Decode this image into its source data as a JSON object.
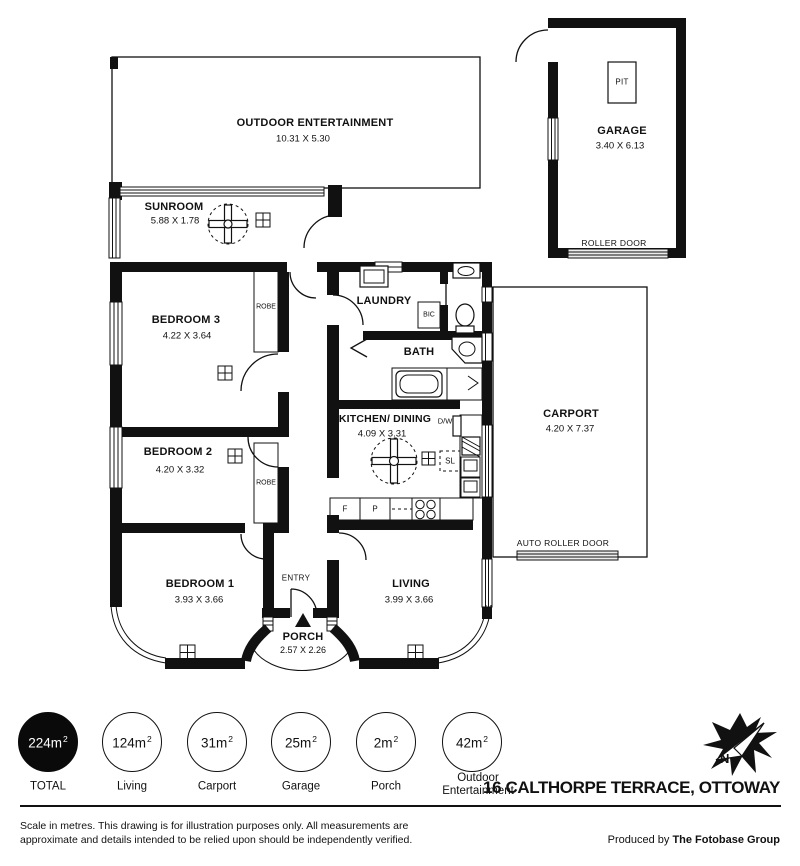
{
  "rooms": {
    "outdoor": {
      "name": "OUTDOOR ENTERTAINMENT",
      "dims": "10.31 X 5.30"
    },
    "garage": {
      "name": "GARAGE",
      "dims": "3.40 X 6.13"
    },
    "sunroom": {
      "name": "SUNROOM",
      "dims": "5.88 X 1.78"
    },
    "bedroom3": {
      "name": "BEDROOM 3",
      "dims": "4.22 X 3.64"
    },
    "laundry": {
      "name": "LAUNDRY"
    },
    "bath": {
      "name": "BATH"
    },
    "bedroom2": {
      "name": "BEDROOM 2",
      "dims": "4.20 X 3.32"
    },
    "kitchen": {
      "name": "KITCHEN/ DINING",
      "dims": "4.09 X 3.31"
    },
    "carport": {
      "name": "CARPORT",
      "dims": "4.20 X 7.37"
    },
    "bedroom1": {
      "name": "BEDROOM 1",
      "dims": "3.93 X 3.66"
    },
    "living": {
      "name": "LIVING",
      "dims": "3.99 X 3.66"
    },
    "porch": {
      "name": "PORCH",
      "dims": "2.57 X 2.26"
    },
    "entry": {
      "name": "ENTRY"
    }
  },
  "fixtures": {
    "pit": "PIT",
    "roller_door": "ROLLER DOOR",
    "auto_roller_door": "AUTO ROLLER DOOR",
    "robe": "ROBE",
    "bic": "BIC",
    "dishwasher": "D/W",
    "skylight": "SL",
    "fridge": "F",
    "pantry": "P"
  },
  "summary": [
    {
      "area": "224m",
      "sup": "2",
      "label": "TOTAL",
      "filled": true
    },
    {
      "area": "124m",
      "sup": "2",
      "label": "Living",
      "filled": false
    },
    {
      "area": "31m",
      "sup": "2",
      "label": "Carport",
      "filled": false
    },
    {
      "area": "25m",
      "sup": "2",
      "label": "Garage",
      "filled": false
    },
    {
      "area": "2m",
      "sup": "2",
      "label": "Porch",
      "filled": false
    },
    {
      "area": "42m",
      "sup": "2",
      "label": "Outdoor Entertainment",
      "filled": false
    }
  ],
  "footer": {
    "address": "16 CALTHORPE TERRACE, OTTOWAY",
    "disclaimer": "Scale in metres. This drawing is for illustration purposes only. All measurements are approximate and details intended to be relied upon should be independently verified.",
    "produced_by": "Produced by",
    "producer": "The Fotobase Group"
  },
  "colors": {
    "ink": "#111111",
    "paper": "#ffffff"
  }
}
